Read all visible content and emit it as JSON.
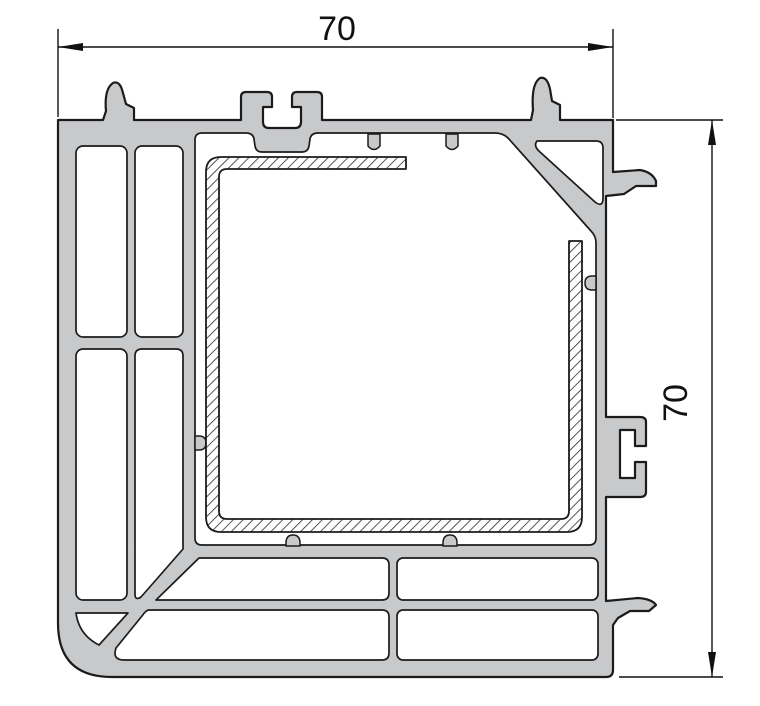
{
  "drawing": {
    "type": "profile-cross-section",
    "dimensions": {
      "width": {
        "label": "70"
      },
      "height": {
        "label": "70"
      }
    },
    "colors": {
      "profile_fill": "#c8c9cb",
      "outline": "#1b1b1b",
      "hatch_line": "#2a2a2a",
      "dimension": "#111111",
      "background": "#ffffff"
    }
  }
}
